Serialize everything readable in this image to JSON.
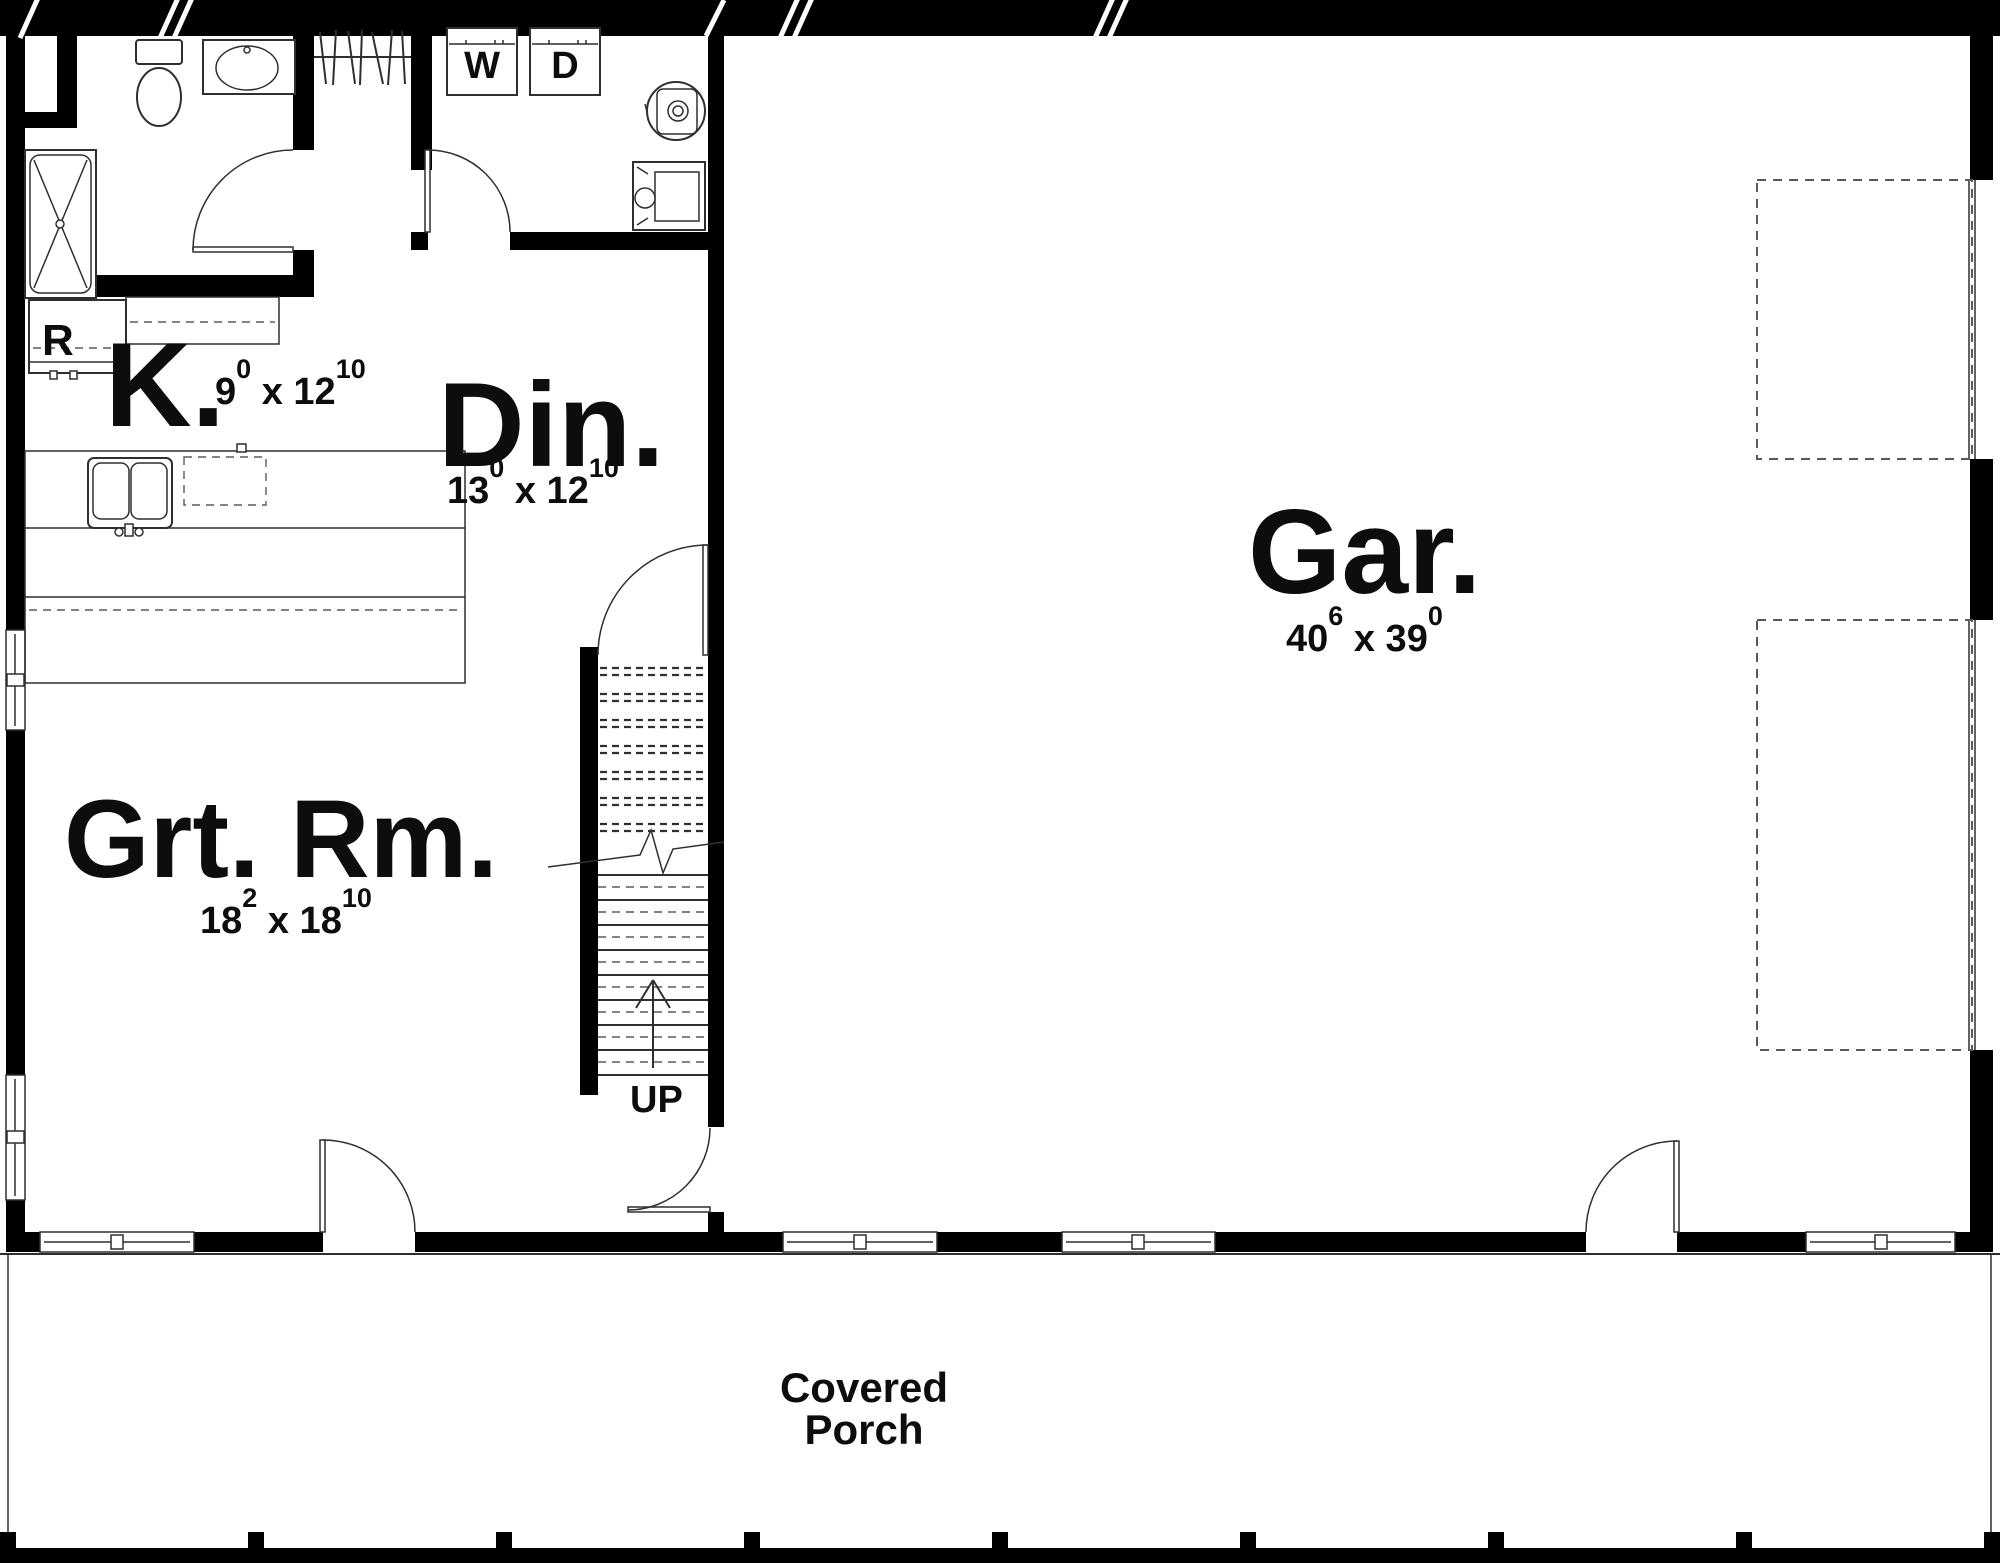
{
  "plan": {
    "rooms": {
      "kitchen": {
        "label": "K.",
        "dim": [
          "9",
          "0",
          " x 12",
          "10"
        ]
      },
      "dining": {
        "label": "Din.",
        "dim": [
          "13",
          "0",
          " x 12",
          "10"
        ]
      },
      "great_room": {
        "label": "Grt. Rm.",
        "dim": [
          "18",
          "2",
          " x 18",
          "10"
        ]
      },
      "garage": {
        "label": "Gar.",
        "dim": [
          "40",
          "6",
          " x 39",
          "0"
        ]
      }
    },
    "labels": {
      "washer": "W",
      "dryer": "D",
      "refrigerator": "R",
      "stairs_up": "UP",
      "porch_line1": "Covered",
      "porch_line2": "Porch"
    },
    "colors": {
      "wall": "#000000",
      "line": "#2f2f2f",
      "dashline": "#5a5a5a",
      "background": "#ffffff",
      "text": "#0d0d0d"
    }
  }
}
